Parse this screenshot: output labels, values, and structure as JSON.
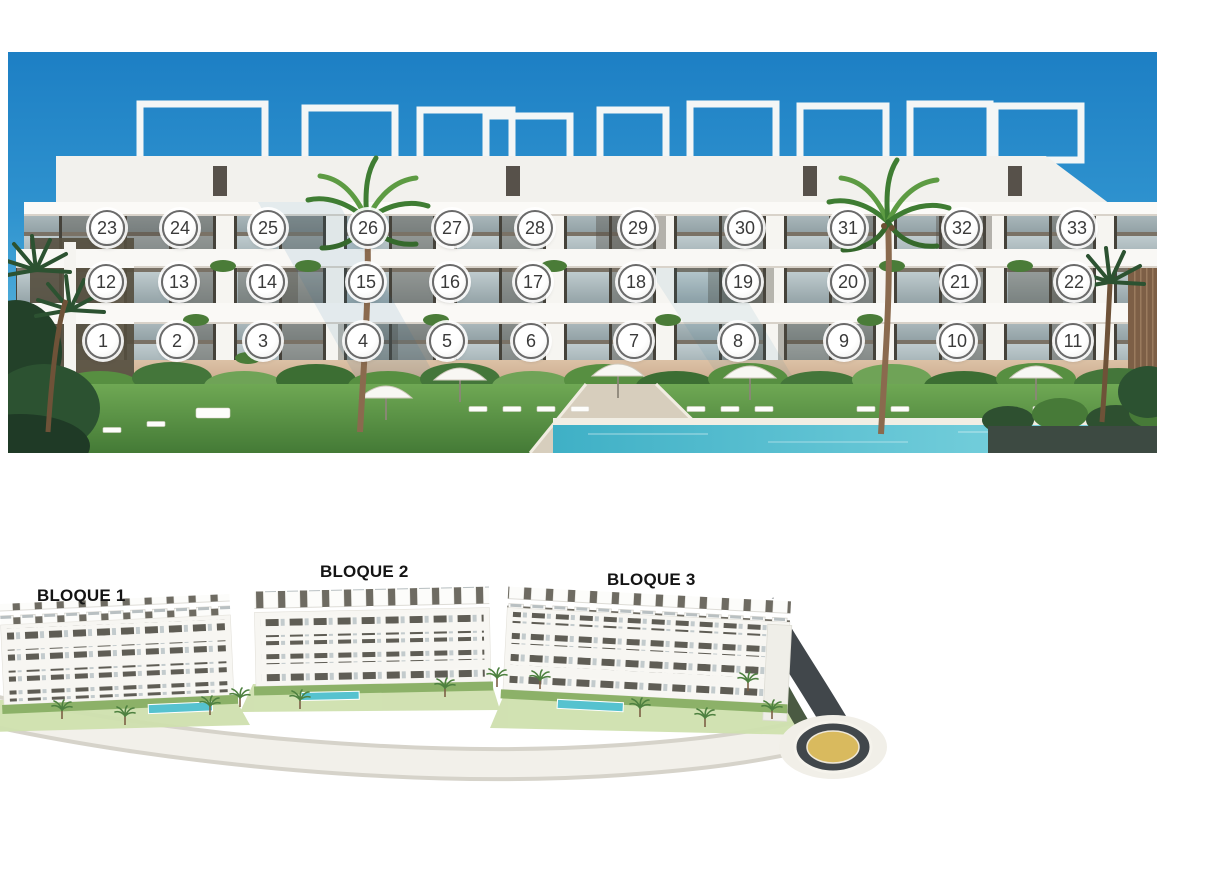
{
  "page": {
    "background": "#ffffff"
  },
  "elevation": {
    "badge_diameter": 36,
    "units": [
      {
        "label": "1",
        "x": 95,
        "y": 289
      },
      {
        "label": "2",
        "x": 169,
        "y": 289
      },
      {
        "label": "3",
        "x": 255,
        "y": 289
      },
      {
        "label": "4",
        "x": 355,
        "y": 289
      },
      {
        "label": "5",
        "x": 439,
        "y": 289
      },
      {
        "label": "6",
        "x": 523,
        "y": 289
      },
      {
        "label": "7",
        "x": 626,
        "y": 289
      },
      {
        "label": "8",
        "x": 730,
        "y": 289
      },
      {
        "label": "9",
        "x": 836,
        "y": 289
      },
      {
        "label": "10",
        "x": 949,
        "y": 289
      },
      {
        "label": "11",
        "x": 1065,
        "y": 289
      },
      {
        "label": "12",
        "x": 98,
        "y": 230
      },
      {
        "label": "13",
        "x": 171,
        "y": 230
      },
      {
        "label": "14",
        "x": 259,
        "y": 230
      },
      {
        "label": "15",
        "x": 358,
        "y": 230
      },
      {
        "label": "16",
        "x": 442,
        "y": 230
      },
      {
        "label": "17",
        "x": 525,
        "y": 230
      },
      {
        "label": "18",
        "x": 628,
        "y": 230
      },
      {
        "label": "19",
        "x": 735,
        "y": 230
      },
      {
        "label": "20",
        "x": 840,
        "y": 230
      },
      {
        "label": "21",
        "x": 952,
        "y": 230
      },
      {
        "label": "22",
        "x": 1066,
        "y": 230
      },
      {
        "label": "23",
        "x": 99,
        "y": 176
      },
      {
        "label": "24",
        "x": 172,
        "y": 176
      },
      {
        "label": "25",
        "x": 260,
        "y": 176
      },
      {
        "label": "26",
        "x": 360,
        "y": 176
      },
      {
        "label": "27",
        "x": 444,
        "y": 176
      },
      {
        "label": "28",
        "x": 527,
        "y": 176
      },
      {
        "label": "29",
        "x": 630,
        "y": 176
      },
      {
        "label": "30",
        "x": 737,
        "y": 176
      },
      {
        "label": "31",
        "x": 840,
        "y": 176
      },
      {
        "label": "32",
        "x": 954,
        "y": 176
      },
      {
        "label": "33",
        "x": 1069,
        "y": 176
      }
    ]
  },
  "siteplan": {
    "blocks": [
      {
        "label": "BLOQUE 1"
      },
      {
        "label": "BLOQUE 2"
      },
      {
        "label": "BLOQUE 3"
      }
    ]
  },
  "colors": {
    "sky_top": "#1d7fc4",
    "sky_horizon": "#a8dcef",
    "facade_white": "#f7f6f2",
    "pool_water": "#3fb0c6",
    "lawn_green": "#5f9a47",
    "road_asphalt": "#41474b",
    "roundabout_center": "#d9ba5e",
    "badge_border": "#6a6a6a",
    "badge_text": "#3a3a3a",
    "label_text": "#141414"
  }
}
